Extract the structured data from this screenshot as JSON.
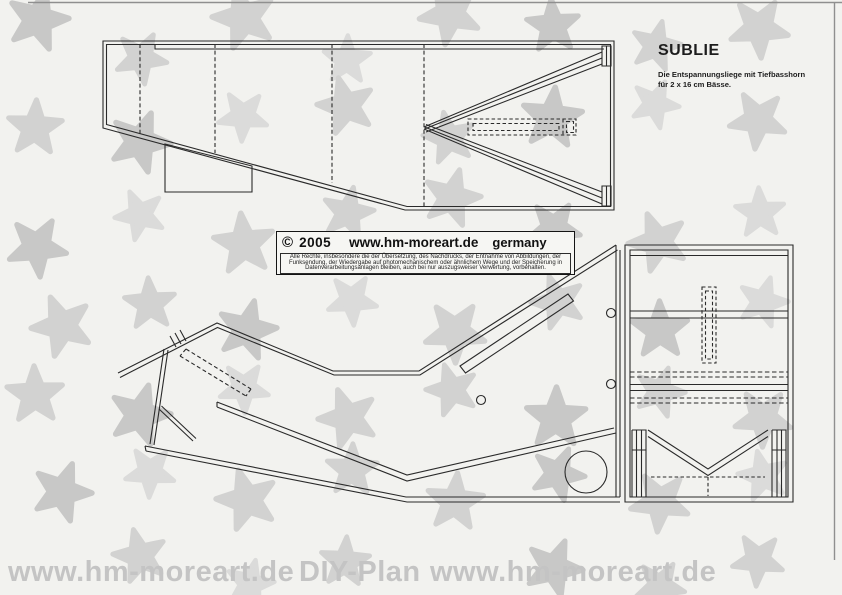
{
  "page": {
    "background": "#f2f2ef",
    "line_color": "#2a2a2a",
    "frame_color": "#8f8f8f"
  },
  "title_block": {
    "title": "SUBLIE",
    "subtitle_line1": "Die Entspannungsliege mit Tiefbasshorn",
    "subtitle_line2": "für 2 x 16 cm Bässe."
  },
  "copyright_box": {
    "symbol": "©",
    "year": "2005",
    "url": "www.hm-moreart.de",
    "region": "germany",
    "fine_print": [
      "Alle Rechte, insbesondere die der Übersetzung, des Nachdrucks, der Entnahme von Abbildungen, der",
      "Funksendung, der Wiedergabe auf photomechanischem oder ähnlichem Wege und der Speicherung in",
      "Datenverarbeitungsanlagen bleiben, auch bei nur auszugsweiser Verwertung, vorbehalten."
    ]
  },
  "footer_watermark": {
    "left": "www.hm-moreart.de",
    "center": "DIY-Plan",
    "right": "www.hm-moreart.de",
    "color": "#c4c4c4"
  },
  "watermark_stars": {
    "colors": [
      "#9f9f9f",
      "#b3b3b3",
      "#c4c4c4"
    ],
    "opacity": 0.5,
    "positions": [
      [
        38,
        20,
        68,
        15,
        0
      ],
      [
        141,
        58,
        58,
        100,
        1
      ],
      [
        244,
        18,
        70,
        200,
        1
      ],
      [
        347,
        60,
        54,
        290,
        2
      ],
      [
        450,
        14,
        68,
        45,
        1
      ],
      [
        553,
        26,
        60,
        140,
        0
      ],
      [
        656,
        46,
        56,
        230,
        1
      ],
      [
        759,
        28,
        66,
        320,
        1
      ],
      [
        35,
        128,
        62,
        75,
        1
      ],
      [
        140,
        142,
        68,
        165,
        0
      ],
      [
        243,
        116,
        56,
        255,
        2
      ],
      [
        346,
        106,
        64,
        345,
        1
      ],
      [
        449,
        138,
        58,
        60,
        1
      ],
      [
        552,
        118,
        68,
        150,
        0
      ],
      [
        655,
        104,
        54,
        240,
        2
      ],
      [
        758,
        120,
        64,
        330,
        1
      ],
      [
        37,
        247,
        66,
        30,
        0
      ],
      [
        140,
        215,
        56,
        120,
        2
      ],
      [
        244,
        244,
        68,
        210,
        1
      ],
      [
        348,
        213,
        58,
        300,
        1
      ],
      [
        452,
        198,
        64,
        15,
        1
      ],
      [
        554,
        228,
        60,
        105,
        0
      ],
      [
        658,
        242,
        66,
        195,
        1
      ],
      [
        760,
        213,
        56,
        285,
        2
      ],
      [
        62,
        326,
        68,
        50,
        1
      ],
      [
        150,
        304,
        58,
        140,
        1
      ],
      [
        247,
        330,
        66,
        230,
        0
      ],
      [
        352,
        300,
        56,
        320,
        2
      ],
      [
        455,
        332,
        68,
        35,
        1
      ],
      [
        558,
        302,
        60,
        125,
        1
      ],
      [
        660,
        330,
        64,
        215,
        0
      ],
      [
        763,
        302,
        56,
        305,
        2
      ],
      [
        35,
        395,
        64,
        70,
        1
      ],
      [
        140,
        415,
        68,
        160,
        0
      ],
      [
        244,
        388,
        56,
        250,
        2
      ],
      [
        348,
        418,
        66,
        340,
        1
      ],
      [
        452,
        390,
        58,
        55,
        1
      ],
      [
        556,
        418,
        68,
        145,
        0
      ],
      [
        660,
        392,
        56,
        235,
        1
      ],
      [
        763,
        418,
        64,
        325,
        1
      ],
      [
        62,
        492,
        66,
        20,
        0
      ],
      [
        150,
        472,
        56,
        110,
        2
      ],
      [
        247,
        500,
        68,
        200,
        1
      ],
      [
        352,
        470,
        58,
        290,
        1
      ],
      [
        455,
        502,
        64,
        5,
        1
      ],
      [
        558,
        474,
        60,
        95,
        0
      ],
      [
        660,
        502,
        66,
        185,
        1
      ],
      [
        763,
        476,
        56,
        275,
        2
      ],
      [
        140,
        556,
        60,
        130,
        1
      ],
      [
        345,
        562,
        56,
        220,
        1
      ],
      [
        554,
        568,
        64,
        310,
        0
      ],
      [
        758,
        560,
        58,
        40,
        1
      ],
      [
        250,
        584,
        54,
        85,
        2
      ],
      [
        660,
        586,
        56,
        175,
        1
      ]
    ]
  }
}
